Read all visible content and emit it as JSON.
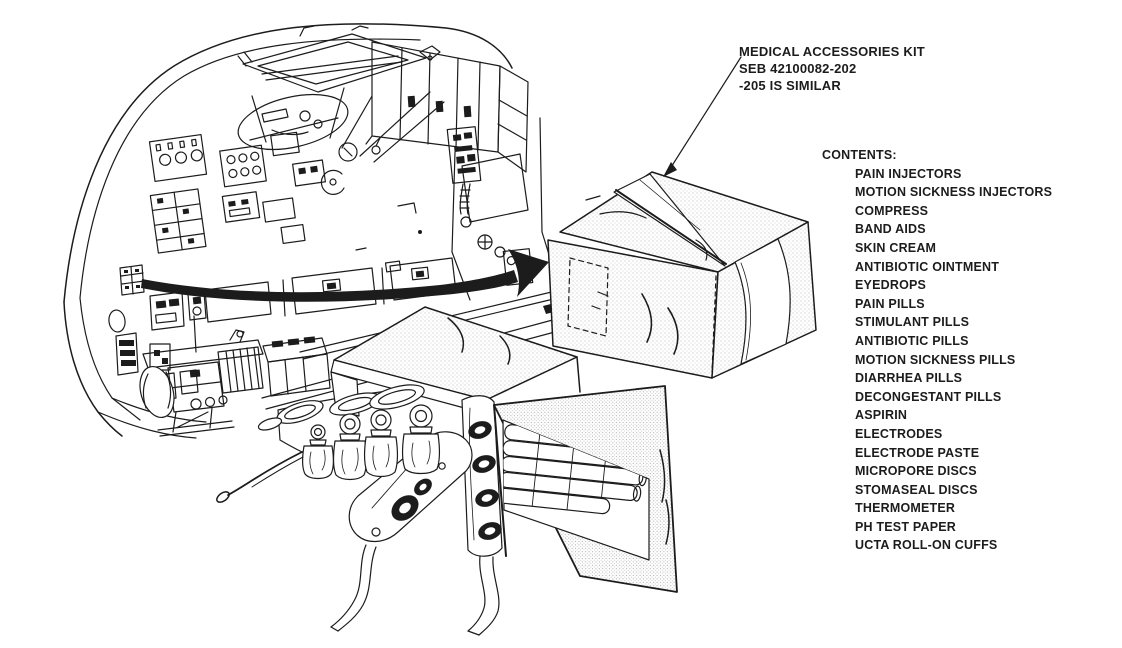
{
  "page": {
    "background": "#ffffff",
    "ink": "#1c1c1c",
    "stipple_shade": "#a8a8a8"
  },
  "callout": {
    "title": "MEDICAL ACCESSORIES KIT",
    "part_number": "SEB 42100082-202",
    "note": "-205 IS SIMILAR"
  },
  "contents": {
    "header": "CONTENTS:",
    "items": [
      "PAIN INJECTORS",
      "MOTION SICKNESS INJECTORS",
      "COMPRESS",
      "BAND AIDS",
      "SKIN CREAM",
      "ANTIBIOTIC OINTMENT",
      "EYEDROPS",
      "PAIN PILLS",
      "STIMULANT PILLS",
      "ANTIBIOTIC PILLS",
      "MOTION SICKNESS PILLS",
      "DIARRHEA PILLS",
      "DECONGESTANT PILLS",
      "ASPIRIN",
      "ELECTRODES",
      "ELECTRODE PASTE",
      "MICROPORE DISCS",
      "STOMASEAL DISCS",
      "THERMOMETER",
      "PH TEST PAPER",
      "UCTA ROLL-ON CUFFS"
    ]
  },
  "illustrations": {
    "panel_icon": "command-module-console-illustration",
    "closed_kit_icon": "closed-kit-illustration",
    "open_kit_icon": "open-kit-illustration",
    "arrow_icon": "stowage-location-arrow"
  }
}
